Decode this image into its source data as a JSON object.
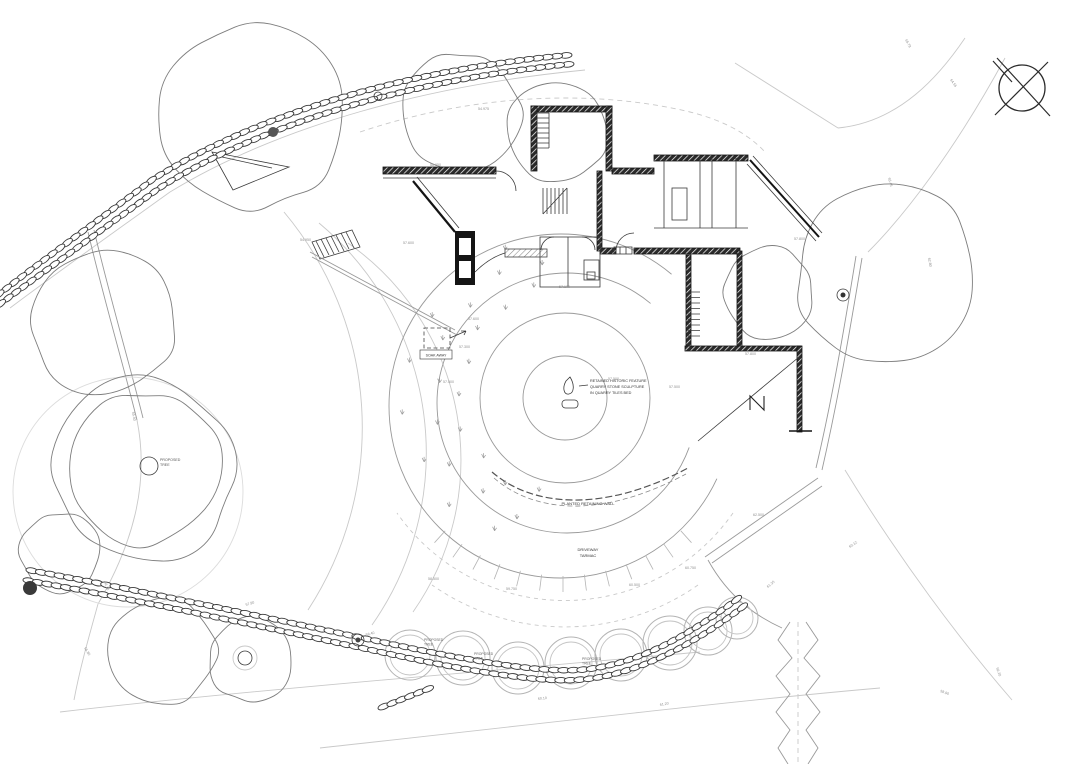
{
  "drawing_type": "architectural site plan",
  "colors": {
    "ink": "#141414",
    "wall_poche": "#2a2a2a",
    "mid_gray": "#8a8a8a",
    "faint_gray": "#c9c9c9",
    "canopy_gray": "#7d7d7d",
    "tree_ring_gray": "#b4b4b4",
    "spot_label_gray": "#8f8f8f"
  },
  "labels": {
    "soak_away": "SOAK AWAY",
    "proposed_tree_l1": "PROPOSED",
    "proposed_tree_l2": "TREE",
    "feature_l1": "RETAINED HISTORIC FEATURE",
    "feature_l2": "QUARRY STONE SCULPTURE",
    "feature_l3": "IN QUARRY TILES BED",
    "retaining_wall": "PLANTED RETAINING WALL",
    "driveway_l1": "DRIVEWAY",
    "driveway_l2": "TARMAC"
  },
  "north_symbol": {
    "icon": "north-point-crossed-circle"
  },
  "spot_elevations": [
    {
      "x": 478,
      "y": 110,
      "v": "54.975",
      "r": 0
    },
    {
      "x": 430,
      "y": 166,
      "v": "56.950",
      "r": 0
    },
    {
      "x": 300,
      "y": 241,
      "v": "54.950",
      "r": 0
    },
    {
      "x": 403,
      "y": 244,
      "v": "57.600",
      "r": 0
    },
    {
      "x": 468,
      "y": 320,
      "v": "57.600",
      "r": 0
    },
    {
      "x": 459,
      "y": 348,
      "v": "57.300",
      "r": 0
    },
    {
      "x": 443,
      "y": 383,
      "v": "57.500",
      "r": 0
    },
    {
      "x": 559,
      "y": 288,
      "v": "57.100",
      "r": 0
    },
    {
      "x": 608,
      "y": 380,
      "v": "57.500",
      "r": 0
    },
    {
      "x": 669,
      "y": 388,
      "v": "57.500",
      "r": 0
    },
    {
      "x": 745,
      "y": 355,
      "v": "57.800",
      "r": 0
    },
    {
      "x": 794,
      "y": 240,
      "v": "57.800",
      "r": 0
    },
    {
      "x": 506,
      "y": 590,
      "v": "59.750",
      "r": 0
    },
    {
      "x": 629,
      "y": 586,
      "v": "60.500",
      "r": 0
    },
    {
      "x": 685,
      "y": 569,
      "v": "60.750",
      "r": 0
    },
    {
      "x": 428,
      "y": 580,
      "v": "58.500",
      "r": 0
    },
    {
      "x": 753,
      "y": 516,
      "v": "62.500",
      "r": 0
    },
    {
      "x": 905,
      "y": 40,
      "v": "65.78",
      "r": 62
    },
    {
      "x": 950,
      "y": 80,
      "v": "64.55",
      "r": 55
    },
    {
      "x": 888,
      "y": 178,
      "v": "63.45",
      "r": 75
    },
    {
      "x": 928,
      "y": 258,
      "v": "62.80",
      "r": 80
    },
    {
      "x": 850,
      "y": 548,
      "v": "60.12",
      "r": -35
    },
    {
      "x": 768,
      "y": 588,
      "v": "61.35",
      "r": -40
    },
    {
      "x": 940,
      "y": 692,
      "v": "58.90",
      "r": 20
    },
    {
      "x": 996,
      "y": 668,
      "v": "59.20",
      "r": 70
    },
    {
      "x": 132,
      "y": 412,
      "v": "55.40",
      "r": 80
    },
    {
      "x": 104,
      "y": 582,
      "v": "56.10",
      "r": 70
    },
    {
      "x": 246,
      "y": 606,
      "v": "57.90",
      "r": -18
    },
    {
      "x": 366,
      "y": 636,
      "v": "58.40",
      "r": -14
    },
    {
      "x": 538,
      "y": 700,
      "v": "60.10",
      "r": -6
    },
    {
      "x": 660,
      "y": 706,
      "v": "61.20",
      "r": -10
    },
    {
      "x": 84,
      "y": 648,
      "v": "55.80",
      "r": 60
    }
  ],
  "proposed_trees": [
    {
      "x": 410,
      "y": 655,
      "r": 25
    },
    {
      "x": 463,
      "y": 658,
      "r": 27
    },
    {
      "x": 518,
      "y": 668,
      "r": 26
    },
    {
      "x": 571,
      "y": 663,
      "r": 26
    },
    {
      "x": 621,
      "y": 655,
      "r": 26
    },
    {
      "x": 670,
      "y": 643,
      "r": 27
    },
    {
      "x": 708,
      "y": 631,
      "r": 24
    },
    {
      "x": 737,
      "y": 618,
      "r": 21
    }
  ],
  "tree_labels": [
    {
      "x": 424,
      "y": 641
    },
    {
      "x": 474,
      "y": 655
    },
    {
      "x": 582,
      "y": 660
    }
  ],
  "canopies": [
    {
      "x": 252,
      "y": 118,
      "r": 92,
      "s": 3
    },
    {
      "x": 462,
      "y": 112,
      "r": 60,
      "s": 5
    },
    {
      "x": 557,
      "y": 132,
      "r": 52,
      "s": 7
    },
    {
      "x": 104,
      "y": 322,
      "r": 72,
      "s": 11
    },
    {
      "x": 143,
      "y": 470,
      "r": 93,
      "s": 13
    },
    {
      "x": 143,
      "y": 470,
      "r": 78,
      "s": 17
    },
    {
      "x": 886,
      "y": 272,
      "r": 92,
      "s": 19
    },
    {
      "x": 768,
      "y": 292,
      "r": 46,
      "s": 23
    },
    {
      "x": 60,
      "y": 553,
      "r": 40,
      "s": 29
    },
    {
      "x": 163,
      "y": 650,
      "r": 54,
      "s": 31
    },
    {
      "x": 250,
      "y": 660,
      "r": 42,
      "s": 37
    }
  ]
}
